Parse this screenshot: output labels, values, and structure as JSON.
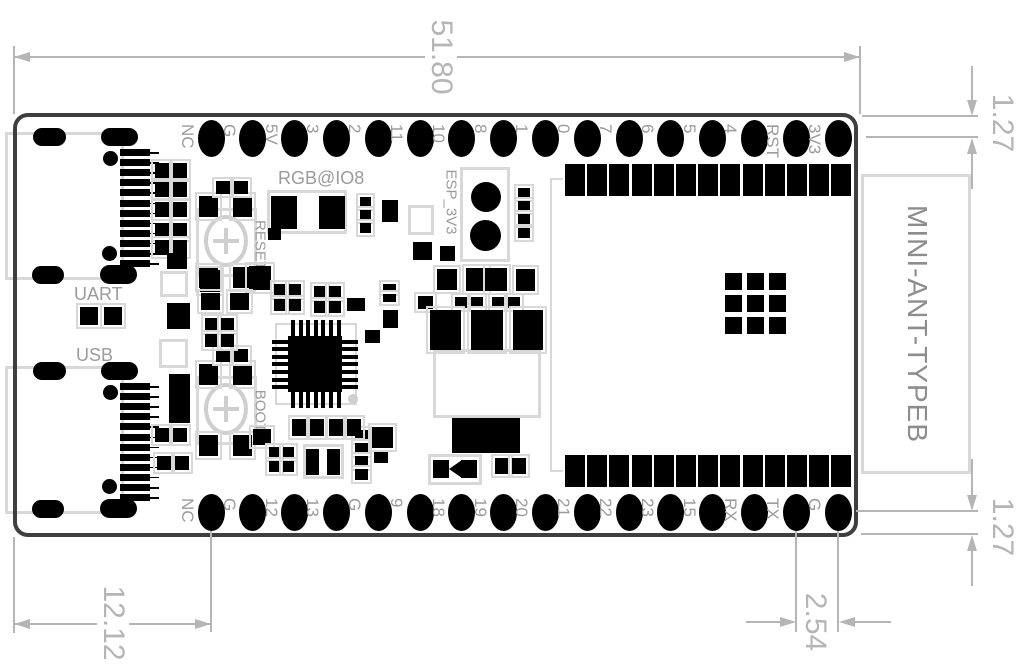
{
  "pins": {
    "top": [
      "NC",
      "G",
      "5V",
      "3",
      "2",
      "11",
      "10",
      "8",
      "1",
      "0",
      "7",
      "6",
      "5",
      "4",
      "RST",
      "3V3"
    ],
    "bottom": [
      "NC",
      "G",
      "12",
      "13",
      "G",
      "9",
      "18",
      "19",
      "20",
      "21",
      "22",
      "23",
      "15",
      "RX",
      "TX",
      "G"
    ]
  },
  "module": {
    "antenna_label": "MINI-ANT-TYPEB",
    "top_pad_count": 13,
    "bottom_pad_count": 13,
    "antenna_grid": {
      "rows": 3,
      "cols": 3
    }
  },
  "connectors": {
    "uart_label": "UART",
    "usb_label": "USB",
    "teeth_per_connector": 12
  },
  "buttons": {
    "reset_label": "RESET",
    "boot_label": "BOOT"
  },
  "silkscreen": {
    "rgb_led_label": "RGB@IO8",
    "esp_jumper_label": "ESP_3V3"
  },
  "dimensions": {
    "board_width": "51.80",
    "top_pin_row_offset": "1.27",
    "bottom_pin_row_offset": "1.27",
    "pin_pitch": "2.54",
    "left_edge_to_first_pin": "12.12"
  },
  "colors": {
    "board_edge": "#3f3f3f",
    "pad_black": "#000000",
    "component_outline": "#d8d8d8",
    "silkscreen_text": "#9b9b9b",
    "dimension": "#b5b5b5"
  }
}
